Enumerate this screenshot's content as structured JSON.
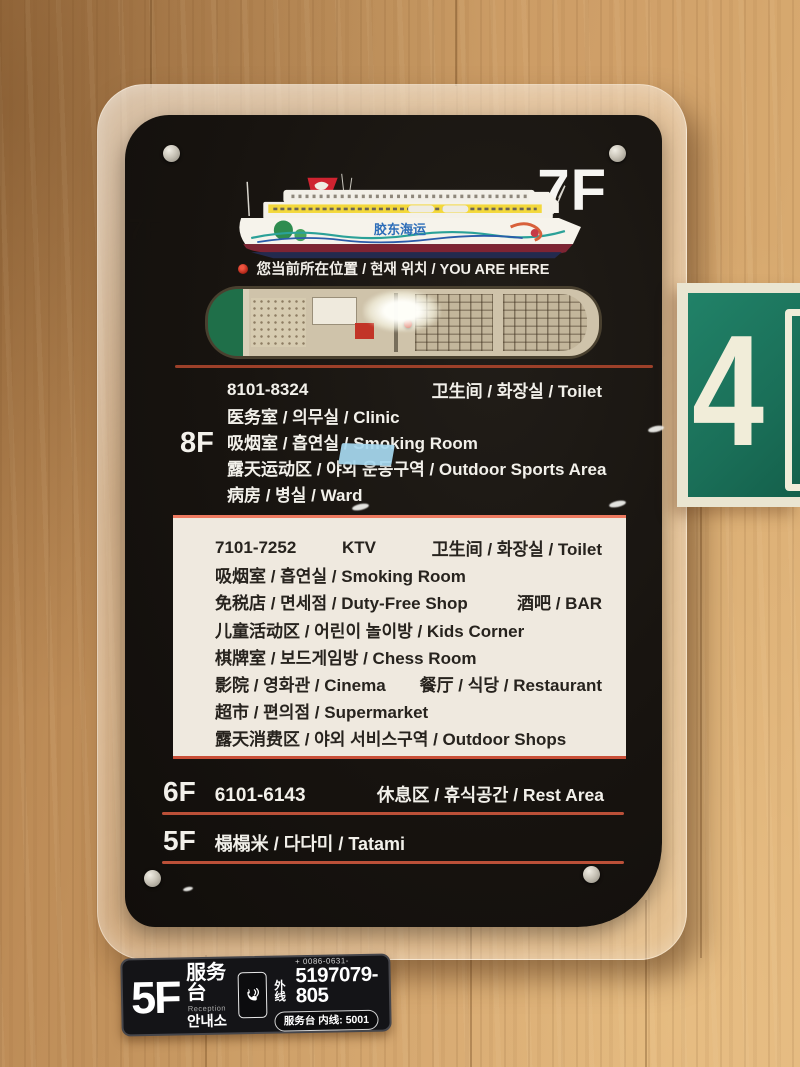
{
  "colors": {
    "accent_red": "#b44a33",
    "panel_black": "#17130f",
    "exit_green": "#1a6f58",
    "wood": "#c99a63",
    "highlight_box": "#efe9df",
    "tape_blue": "#a6d8ef"
  },
  "main_sign": {
    "current_floor": "7F",
    "ship_brand": "胶东海运",
    "you_are_here": "您当前所在位置 / 현재 위치 / YOU ARE HERE",
    "floors": [
      {
        "label": "8F",
        "rows": [
          {
            "left": "8101-8324",
            "right": "卫生间 / 화장실 / Toilet"
          },
          {
            "left": "医务室 / 의무실 / Clinic"
          },
          {
            "left": "吸烟室 / 흡연실 / Smoking Room"
          },
          {
            "left": "露天运动区 / 야외 운동구역 / Outdoor Sports Area"
          },
          {
            "left": "病房 / 병실 / Ward"
          }
        ]
      },
      {
        "label": "7F",
        "rows": [
          {
            "left": "7101-7252",
            "mid": "KTV",
            "right": "卫生间 / 화장실 / Toilet"
          },
          {
            "left": "吸烟室 / 흡연실 / Smoking Room"
          },
          {
            "left": "免税店 / 면세점 / Duty-Free Shop",
            "right": "酒吧 / BAR"
          },
          {
            "left": "儿童活动区 / 어린이 놀이방 / Kids Corner"
          },
          {
            "left": "棋牌室 / 보드게임방 / Chess Room"
          },
          {
            "left": "影院 / 영화관 / Cinema",
            "right": "餐厅 / 식당 / Restaurant"
          },
          {
            "left": "超市 / 편의점 / Supermarket"
          },
          {
            "left": "露天消费区 / 야외 서비스구역 / Outdoor Shops"
          }
        ]
      },
      {
        "label": "6F",
        "rooms": "6101-6143",
        "right": "休息区 / 휴식공간 / Rest Area"
      },
      {
        "label": "5F",
        "left": "榻榻米 / 다다미 / Tatami"
      }
    ]
  },
  "exit_sign": {
    "number": "4"
  },
  "reception_sign": {
    "floor": "5F",
    "title_zh": "服务台",
    "title_en": "Reception",
    "title_ko": "안내소",
    "external_label": "外线",
    "phone_prefix": "+ 0086-0631-",
    "phone_number": "5197079-805",
    "internal_line": "服务台 内线: 5001"
  }
}
